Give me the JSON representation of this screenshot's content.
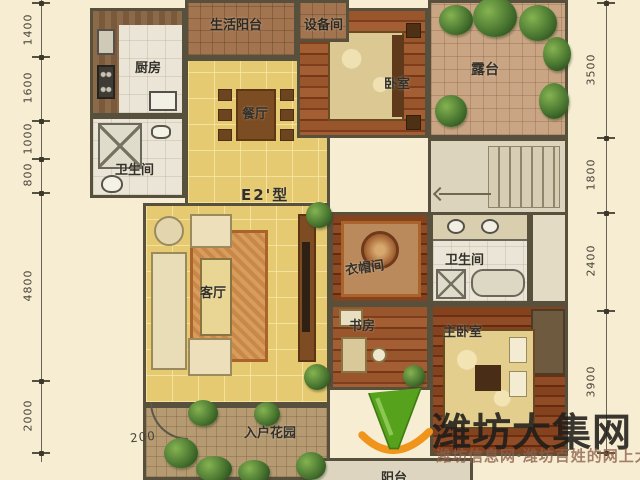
{
  "plan": {
    "type_label": "E2'型",
    "rooms": {
      "service_balcony": "生活阳台",
      "equipment": "设备间",
      "kitchen": "厨房",
      "bedroom2": "卧室",
      "terrace": "露台",
      "bath1": "卫生间",
      "dining": "餐厅",
      "living": "客厅",
      "cloakroom": "衣帽间",
      "bath2": "卫生间",
      "study": "书房",
      "master_bedroom": "主卧室",
      "entry_garden": "入户花园",
      "balcony": "阳台"
    },
    "door_dim": "200"
  },
  "dims": {
    "left": [
      "1400",
      "1600",
      "1000",
      "800",
      "4800",
      "2000"
    ],
    "right": [
      "3500",
      "1800",
      "2400",
      "3900"
    ]
  },
  "watermark": {
    "site_name": "潍坊大集网",
    "tagline": "潍坊信息网·潍坊百姓的网上大集",
    "logo_green": "#57a21d",
    "logo_orange": "#f0941c"
  }
}
